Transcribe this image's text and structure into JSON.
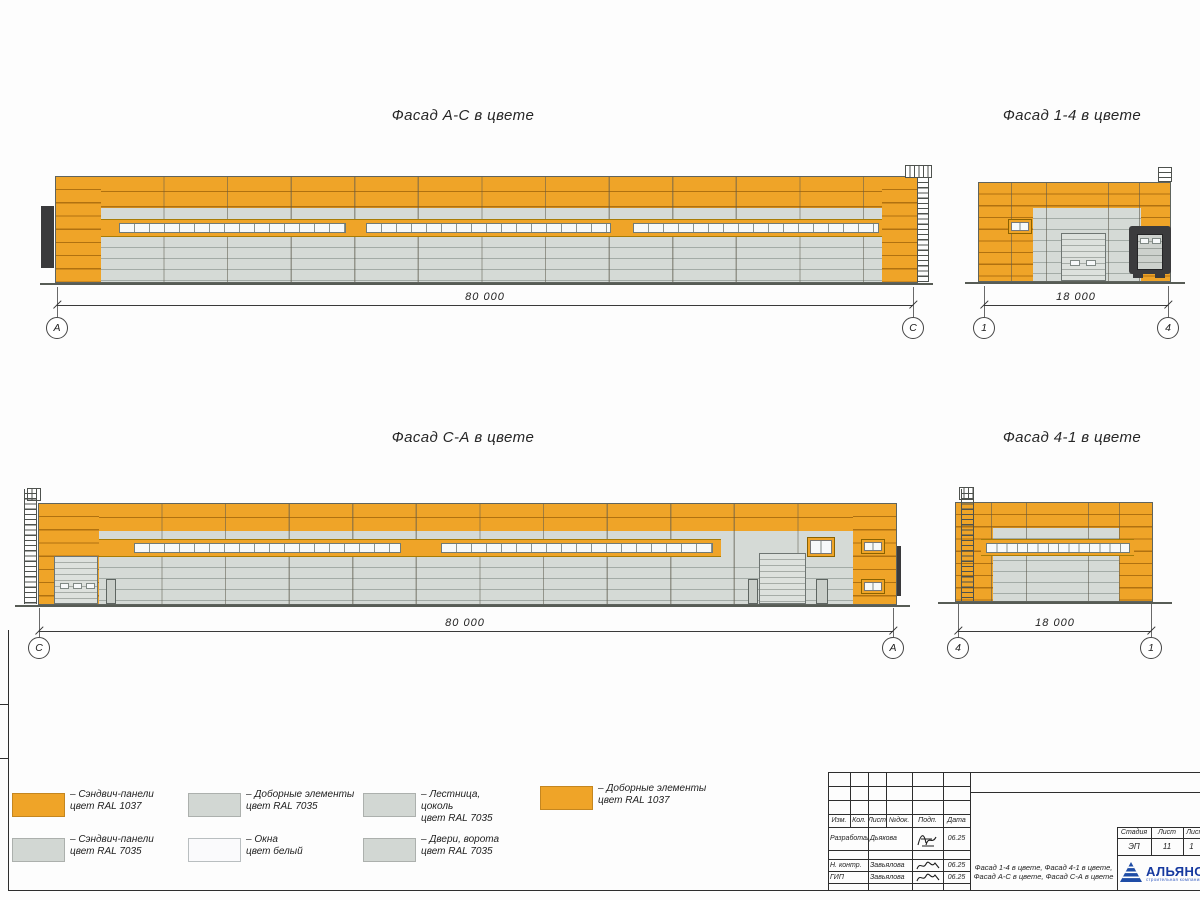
{
  "colors": {
    "orange": "#EFA428",
    "panel-gray": "#D5DAD6",
    "window-white": "#F7F9FA",
    "dock-dark": "#3B3B3D",
    "line-dark": "#2E2E2E"
  },
  "facades": {
    "ac": {
      "title": "Фасад А-С в цвете",
      "dim": "80 000",
      "bubble_left": "А",
      "bubble_right": "С"
    },
    "f14": {
      "title": "Фасад 1-4 в цвете",
      "dim": "18 000",
      "bubble_left": "1",
      "bubble_right": "4"
    },
    "ca": {
      "title": "Фасад С-А в цвете",
      "dim": "80 000",
      "bubble_left": "С",
      "bubble_right": "А"
    },
    "f41": {
      "title": "Фасад 4-1 в цвете",
      "dim": "18 000",
      "bubble_left": "4",
      "bubble_right": "1"
    }
  },
  "legend": {
    "items": [
      {
        "swatch": "orange",
        "label": "– Сэндвич-панели\nцвет RAL 1037"
      },
      {
        "swatch": "gray",
        "label": "– Сэндвич-панели\nцвет RAL 7035"
      },
      {
        "swatch": "gray",
        "label": "– Доборные элементы\nцвет RAL 7035"
      },
      {
        "swatch": "white",
        "label": "– Окна\nцвет белый"
      },
      {
        "swatch": "gray",
        "label": "– Лестница,\nцоколь\nцвет RAL 7035"
      },
      {
        "swatch": "gray",
        "label": "– Двери, ворота\nцвет RAL 7035"
      },
      {
        "swatch": "orange",
        "label": "– Доборные элементы\nцвет RAL 1037"
      }
    ]
  },
  "titleblock": {
    "cols": [
      "Изм.",
      "Кол.",
      "Лист",
      "№док.",
      "Подп.",
      "Дата"
    ],
    "rows": [
      {
        "role": "Разработал",
        "name": "Дьякова",
        "date": "06.25"
      },
      {
        "role": "Н. контр.",
        "name": "Завьялова",
        "date": "06.25"
      },
      {
        "role": "ГИП",
        "name": "Завьялова",
        "date": "06.25"
      }
    ],
    "stage_label": "Стадия",
    "sheet_label": "Лист",
    "sheets_label": "Листов",
    "stage": "ЭП",
    "sheet": "11",
    "sheets": "1",
    "doc_title": "Фасад 1-4 в цвете, Фасад 4-1 в цвете, Фасад А-С в цвете, Фасад С-А в цвете",
    "company": "АЛЬЯНС",
    "company_sub": "строительная компания"
  }
}
